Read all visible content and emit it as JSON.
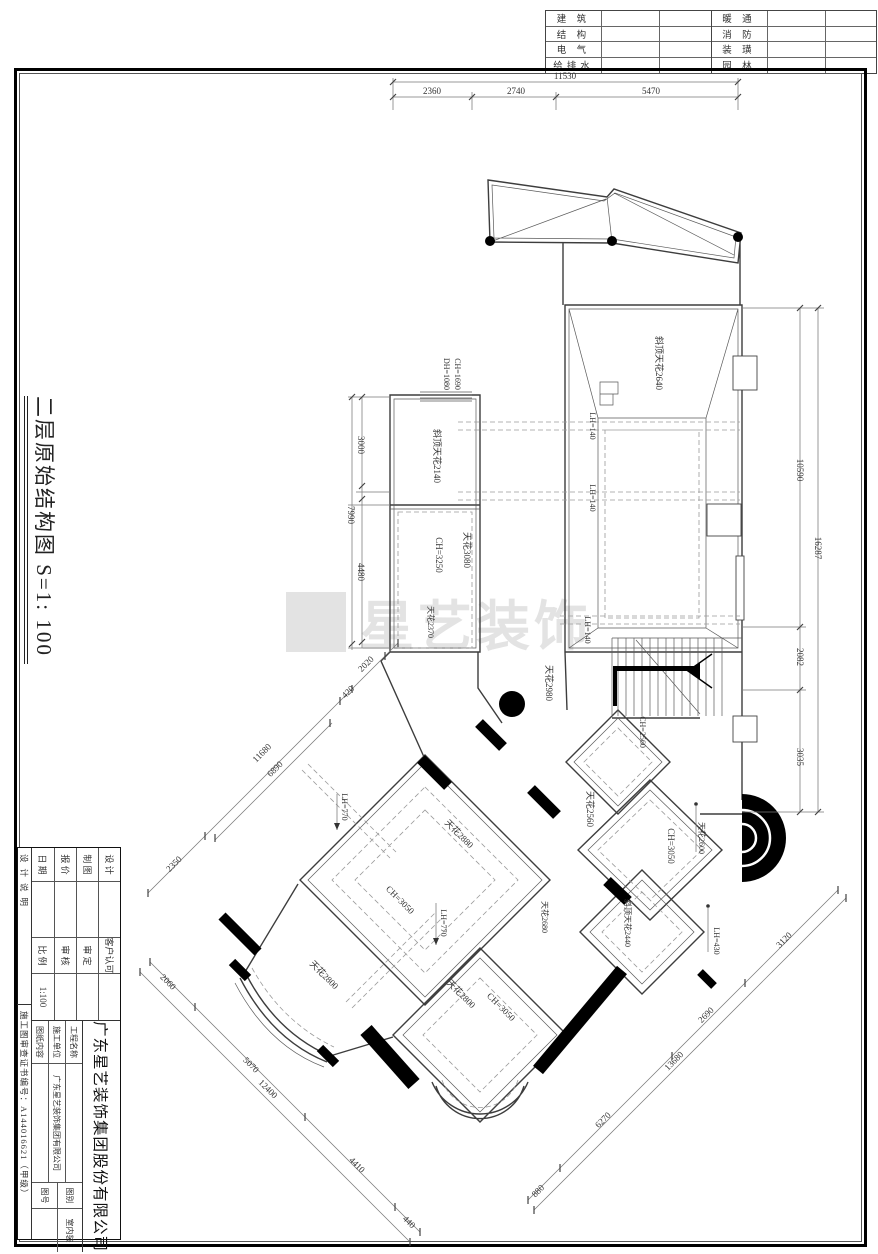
{
  "sheet": {
    "side_title": "二层原始结构图  S=1: 100",
    "watermark": "星艺装饰",
    "discipline_table": {
      "left_rows": [
        "建 筑",
        "结 构",
        "电 气",
        "给排水"
      ],
      "right_rows": [
        "暖 通",
        "消 防",
        "装 璜",
        "园 林"
      ]
    }
  },
  "title_block": {
    "company_full": "广东星艺装饰集团股份有限公司",
    "rows_left": [
      {
        "label": "设 计",
        "value": ""
      },
      {
        "label": "制 图",
        "value": ""
      },
      {
        "label": "报 价",
        "value": ""
      },
      {
        "label": "日 期",
        "value": ""
      }
    ],
    "rows_mid": [
      {
        "label": "客户认可",
        "value": ""
      },
      {
        "label": "审 定",
        "value": ""
      },
      {
        "label": "审 核",
        "value": ""
      },
      {
        "label": "比 例",
        "value": "1:100"
      }
    ],
    "rows_right": [
      {
        "label": "工程名称",
        "value": ""
      },
      {
        "label": "施工单位",
        "value": "广东星艺装饰集团有限公司"
      },
      {
        "label": "图纸内容",
        "value": ""
      }
    ],
    "rows_far": [
      {
        "label": "图别",
        "value": "室内装"
      },
      {
        "label": "图号",
        "value": ""
      }
    ],
    "note_left": "设计说明",
    "note_bottom": "施工图审查证书编号：A144016621（甲级）"
  },
  "plan": {
    "annotations": [
      {
        "k": "dim",
        "t": "11530",
        "x": 565,
        "y": 79,
        "r": 0
      },
      {
        "k": "dim",
        "t": "2360",
        "x": 432,
        "y": 94,
        "r": 0
      },
      {
        "k": "dim",
        "t": "2740",
        "x": 516,
        "y": 94,
        "r": 0
      },
      {
        "k": "dim",
        "t": "5470",
        "x": 651,
        "y": 94,
        "r": 0
      },
      {
        "k": "dim",
        "t": "10590",
        "x": 797,
        "y": 470,
        "r": 90
      },
      {
        "k": "dim",
        "t": "16287",
        "x": 815,
        "y": 548,
        "r": 90
      },
      {
        "k": "dim",
        "t": "2082",
        "x": 797,
        "y": 657,
        "r": 90
      },
      {
        "k": "dim",
        "t": "3035",
        "x": 797,
        "y": 757,
        "r": 90
      },
      {
        "k": "dim",
        "t": "3000",
        "x": 358,
        "y": 445,
        "r": 90
      },
      {
        "k": "dim",
        "t": "7990",
        "x": 348,
        "y": 515,
        "r": 90
      },
      {
        "k": "dim",
        "t": "4480",
        "x": 358,
        "y": 572,
        "r": 90
      },
      {
        "k": "dim",
        "t": "2350",
        "x": 176,
        "y": 866,
        "r": -45
      },
      {
        "k": "dim",
        "t": "11680",
        "x": 264,
        "y": 755,
        "r": -45
      },
      {
        "k": "dim",
        "t": "6890",
        "x": 277,
        "y": 771,
        "r": -45
      },
      {
        "k": "dim",
        "t": "420",
        "x": 350,
        "y": 694,
        "r": -45
      },
      {
        "k": "dim",
        "t": "2020",
        "x": 368,
        "y": 666,
        "r": -45
      },
      {
        "k": "dim",
        "t": "2060",
        "x": 166,
        "y": 984,
        "r": 45
      },
      {
        "k": "dim",
        "t": "5070",
        "x": 249,
        "y": 1067,
        "r": 45
      },
      {
        "k": "dim",
        "t": "12400",
        "x": 266,
        "y": 1091,
        "r": 45
      },
      {
        "k": "dim",
        "t": "4410",
        "x": 355,
        "y": 1167,
        "r": 45
      },
      {
        "k": "dim",
        "t": "440",
        "x": 407,
        "y": 1224,
        "r": 45
      },
      {
        "k": "dim",
        "t": "880",
        "x": 540,
        "y": 1193,
        "r": -45
      },
      {
        "k": "dim",
        "t": "6270",
        "x": 605,
        "y": 1122,
        "r": -45
      },
      {
        "k": "dim",
        "t": "13680",
        "x": 676,
        "y": 1063,
        "r": -45
      },
      {
        "k": "dim",
        "t": "2690",
        "x": 708,
        "y": 1017,
        "r": -45
      },
      {
        "k": "dim",
        "t": "3120",
        "x": 786,
        "y": 942,
        "r": -45
      },
      {
        "k": "label",
        "t": "DH=1080",
        "x": 444,
        "y": 374,
        "r": 90,
        "fs": 8
      },
      {
        "k": "label",
        "t": "CH=1690",
        "x": 455,
        "y": 374,
        "r": 90,
        "fs": 8
      },
      {
        "k": "label",
        "t": "斜顶天花2140",
        "x": 434,
        "y": 456,
        "r": 90
      },
      {
        "k": "label",
        "t": "斜顶天花2640",
        "x": 656,
        "y": 363,
        "r": 90
      },
      {
        "k": "label",
        "t": "LH=140",
        "x": 590,
        "y": 426,
        "r": 90,
        "fs": 8
      },
      {
        "k": "label",
        "t": "LH=140",
        "x": 590,
        "y": 498,
        "r": 90,
        "fs": 8
      },
      {
        "k": "label",
        "t": "LH=140",
        "x": 585,
        "y": 630,
        "r": 90,
        "fs": 8
      },
      {
        "k": "label",
        "t": "CH=3250",
        "x": 436,
        "y": 555,
        "r": 90
      },
      {
        "k": "label",
        "t": "天花3080",
        "x": 464,
        "y": 550,
        "r": 90
      },
      {
        "k": "label",
        "t": "天花2370",
        "x": 428,
        "y": 622,
        "r": 90,
        "fs": 8
      },
      {
        "k": "label",
        "t": "天花2980",
        "x": 546,
        "y": 683,
        "r": 90
      },
      {
        "k": "label",
        "t": "CH=2560",
        "x": 640,
        "y": 732,
        "r": 90,
        "fs": 8
      },
      {
        "k": "label",
        "t": "天花2560",
        "x": 587,
        "y": 809,
        "r": 90
      },
      {
        "k": "label",
        "t": "CH=3050",
        "x": 668,
        "y": 846,
        "r": 90
      },
      {
        "k": "label",
        "t": "天花2600",
        "x": 699,
        "y": 838,
        "r": 90,
        "fs": 8
      },
      {
        "k": "label",
        "t": "斜顶天花2440",
        "x": 625,
        "y": 923,
        "r": 90,
        "fs": 8
      },
      {
        "k": "label",
        "t": "天花2680",
        "x": 542,
        "y": 917,
        "r": 90,
        "fs": 8
      },
      {
        "k": "label",
        "t": "LH=430",
        "x": 714,
        "y": 941,
        "r": 90,
        "fs": 8
      },
      {
        "k": "label",
        "t": "LH=770",
        "x": 342,
        "y": 807,
        "r": 90,
        "fs": 8
      },
      {
        "k": "label",
        "t": "LH=770",
        "x": 441,
        "y": 923,
        "r": 90,
        "fs": 8
      },
      {
        "k": "label",
        "t": "天花2880",
        "x": 457,
        "y": 836,
        "r": 45
      },
      {
        "k": "label",
        "t": "CH=3050",
        "x": 398,
        "y": 902,
        "r": 45
      },
      {
        "k": "label",
        "t": "天花2800",
        "x": 322,
        "y": 977,
        "r": 45
      },
      {
        "k": "label",
        "t": "天花2800",
        "x": 459,
        "y": 996,
        "r": 45
      },
      {
        "k": "label",
        "t": "CH=3050",
        "x": 499,
        "y": 1009,
        "r": 45
      }
    ]
  }
}
